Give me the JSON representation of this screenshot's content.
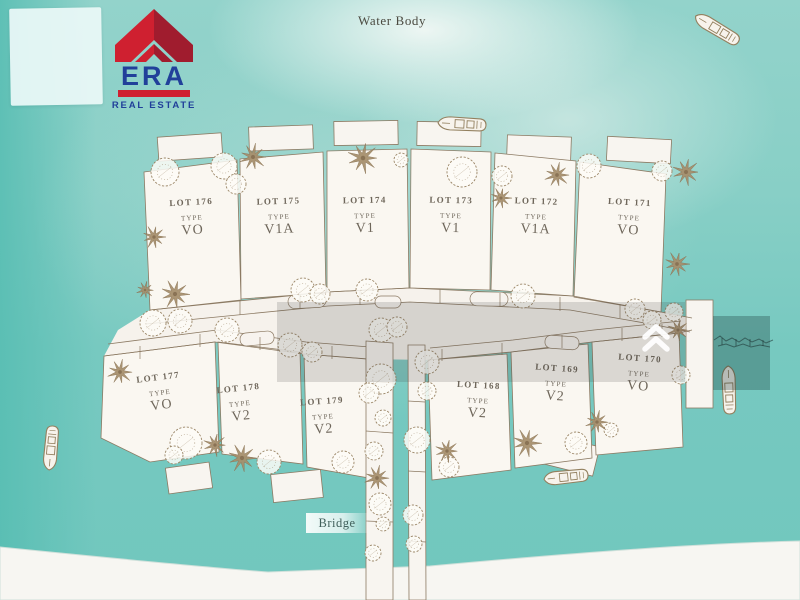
{
  "branding": {
    "name": "ERA",
    "subtitle": "REAL ESTATE",
    "colors": {
      "red": "#cf2030",
      "dark_red": "#a01c2e",
      "navy": "#21409a"
    }
  },
  "map": {
    "water_label": "Water Body",
    "bridge_label": "Bridge",
    "lots": [
      {
        "lot": "LOT 176",
        "type_label": "TYPE",
        "type": "VO"
      },
      {
        "lot": "LOT 175",
        "type_label": "TYPE",
        "type": "V1A"
      },
      {
        "lot": "LOT 174",
        "type_label": "TYPE",
        "type": "V1"
      },
      {
        "lot": "LOT 173",
        "type_label": "TYPE",
        "type": "V1"
      },
      {
        "lot": "LOT 172",
        "type_label": "TYPE",
        "type": "V1A"
      },
      {
        "lot": "LOT 171",
        "type_label": "TYPE",
        "type": "VO"
      },
      {
        "lot": "LOT 177",
        "type_label": "TYPE",
        "type": "VO"
      },
      {
        "lot": "LOT 178",
        "type_label": "TYPE",
        "type": "V2"
      },
      {
        "lot": "LOT 179",
        "type_label": "TYPE",
        "type": "V2"
      },
      {
        "lot": "LOT 168",
        "type_label": "TYPE",
        "type": "V2"
      },
      {
        "lot": "LOT 169",
        "type_label": "TYPE",
        "type": "V2"
      },
      {
        "lot": "LOT 170",
        "type_label": "TYPE",
        "type": "VO"
      }
    ],
    "palette": {
      "water": "#77c9c0",
      "land": "#f8f5f0",
      "outline": "#8c7a63",
      "tree_tan": "#a68e6b"
    },
    "decorations": {
      "palms": [
        {
          "x": 154,
          "y": 237,
          "r": 12
        },
        {
          "x": 253,
          "y": 157,
          "r": 14
        },
        {
          "x": 363,
          "y": 158,
          "r": 16
        },
        {
          "x": 501,
          "y": 198,
          "r": 11
        },
        {
          "x": 557,
          "y": 175,
          "r": 13
        },
        {
          "x": 686,
          "y": 172,
          "r": 14
        },
        {
          "x": 677,
          "y": 264,
          "r": 13
        },
        {
          "x": 120,
          "y": 372,
          "r": 13
        },
        {
          "x": 215,
          "y": 445,
          "r": 12
        },
        {
          "x": 242,
          "y": 458,
          "r": 15
        },
        {
          "x": 377,
          "y": 478,
          "r": 13
        },
        {
          "x": 447,
          "y": 451,
          "r": 12
        },
        {
          "x": 527,
          "y": 443,
          "r": 15
        },
        {
          "x": 597,
          "y": 422,
          "r": 12
        },
        {
          "x": 678,
          "y": 330,
          "r": 11
        },
        {
          "x": 175,
          "y": 294,
          "r": 15
        },
        {
          "x": 145,
          "y": 290,
          "r": 9
        }
      ],
      "trees": [
        {
          "x": 165,
          "y": 172,
          "r": 14
        },
        {
          "x": 224,
          "y": 166,
          "r": 13
        },
        {
          "x": 236,
          "y": 184,
          "r": 10
        },
        {
          "x": 462,
          "y": 172,
          "r": 15
        },
        {
          "x": 502,
          "y": 176,
          "r": 10
        },
        {
          "x": 401,
          "y": 160,
          "r": 7
        },
        {
          "x": 589,
          "y": 166,
          "r": 12
        },
        {
          "x": 662,
          "y": 171,
          "r": 10
        },
        {
          "x": 523,
          "y": 296,
          "r": 12
        },
        {
          "x": 186,
          "y": 443,
          "r": 16
        },
        {
          "x": 174,
          "y": 455,
          "r": 9
        },
        {
          "x": 269,
          "y": 462,
          "r": 12
        },
        {
          "x": 153,
          "y": 323,
          "r": 13
        },
        {
          "x": 180,
          "y": 321,
          "r": 12
        },
        {
          "x": 227,
          "y": 330,
          "r": 12
        },
        {
          "x": 303,
          "y": 290,
          "r": 12
        },
        {
          "x": 320,
          "y": 294,
          "r": 10
        },
        {
          "x": 367,
          "y": 290,
          "r": 11
        },
        {
          "x": 381,
          "y": 330,
          "r": 12
        },
        {
          "x": 397,
          "y": 327,
          "r": 10
        },
        {
          "x": 290,
          "y": 345,
          "r": 12
        },
        {
          "x": 312,
          "y": 352,
          "r": 10
        },
        {
          "x": 381,
          "y": 379,
          "r": 15
        },
        {
          "x": 369,
          "y": 393,
          "r": 10
        },
        {
          "x": 383,
          "y": 418,
          "r": 8
        },
        {
          "x": 374,
          "y": 451,
          "r": 9
        },
        {
          "x": 343,
          "y": 462,
          "r": 11
        },
        {
          "x": 427,
          "y": 362,
          "r": 12
        },
        {
          "x": 427,
          "y": 391,
          "r": 9
        },
        {
          "x": 417,
          "y": 440,
          "r": 13
        },
        {
          "x": 449,
          "y": 467,
          "r": 10
        },
        {
          "x": 380,
          "y": 504,
          "r": 11
        },
        {
          "x": 413,
          "y": 515,
          "r": 10
        },
        {
          "x": 383,
          "y": 524,
          "r": 7
        },
        {
          "x": 373,
          "y": 553,
          "r": 8
        },
        {
          "x": 414,
          "y": 544,
          "r": 8
        },
        {
          "x": 576,
          "y": 443,
          "r": 11
        },
        {
          "x": 611,
          "y": 430,
          "r": 7
        },
        {
          "x": 681,
          "y": 375,
          "r": 9
        },
        {
          "x": 635,
          "y": 309,
          "r": 10
        },
        {
          "x": 652,
          "y": 320,
          "r": 9
        },
        {
          "x": 674,
          "y": 312,
          "r": 9
        }
      ],
      "boats": [
        {
          "x": 717,
          "y": 29,
          "rot": 31,
          "len": 52
        },
        {
          "x": 462,
          "y": 124,
          "rot": 3,
          "len": 50
        },
        {
          "x": 51,
          "y": 448,
          "rot": -85,
          "len": 46
        },
        {
          "x": 729,
          "y": 390,
          "rot": 88,
          "len": 50
        },
        {
          "x": 566,
          "y": 477,
          "rot": -6,
          "len": 46
        }
      ],
      "ties": [
        [
          176,
          313,
          176,
          327
        ],
        [
          240,
          301,
          240,
          315
        ],
        [
          300,
          295,
          300,
          309
        ],
        [
          360,
          291,
          360,
          305
        ],
        [
          440,
          289,
          440,
          303
        ],
        [
          500,
          293,
          500,
          307
        ],
        [
          560,
          297,
          560,
          311
        ],
        [
          620,
          304,
          620,
          318
        ],
        [
          140,
          346,
          140,
          359
        ],
        [
          200,
          334,
          200,
          347
        ],
        [
          260,
          337,
          260,
          350
        ],
        [
          332,
          346,
          332,
          359
        ],
        [
          442,
          349,
          442,
          361
        ],
        [
          502,
          343,
          502,
          355
        ],
        [
          562,
          335,
          562,
          348
        ],
        [
          622,
          328,
          622,
          341
        ],
        [
          662,
          324,
          662,
          337
        ],
        [
          366,
          381,
          393,
          383
        ],
        [
          366,
          431,
          393,
          433
        ],
        [
          408,
          401,
          425,
          402
        ],
        [
          408,
          471,
          426,
          472
        ],
        [
          366,
          521,
          393,
          522
        ],
        [
          409,
          541,
          426,
          542
        ]
      ]
    }
  }
}
